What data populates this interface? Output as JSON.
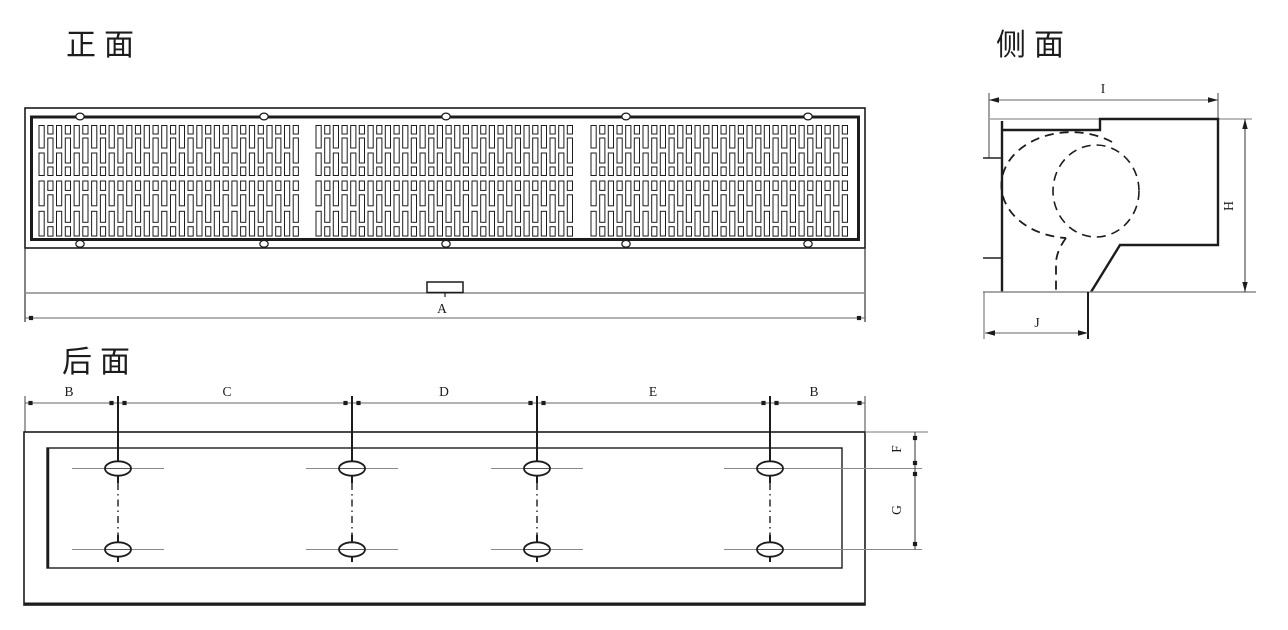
{
  "views": {
    "front": {
      "title": "正面",
      "dim_a": "A"
    },
    "side": {
      "title": "侧面",
      "dim_i": "I",
      "dim_h": "H",
      "dim_j": "J"
    },
    "back": {
      "title": "后面",
      "dim_b_left": "B",
      "dim_c": "C",
      "dim_d": "D",
      "dim_e": "E",
      "dim_b_right": "B",
      "dim_f": "F",
      "dim_g": "G"
    }
  },
  "colors": {
    "outline": "#1c1c1c",
    "thin_line": "#777777",
    "dim_line": "#666666",
    "centerline": "#8a8a8a",
    "background": "#ffffff"
  }
}
